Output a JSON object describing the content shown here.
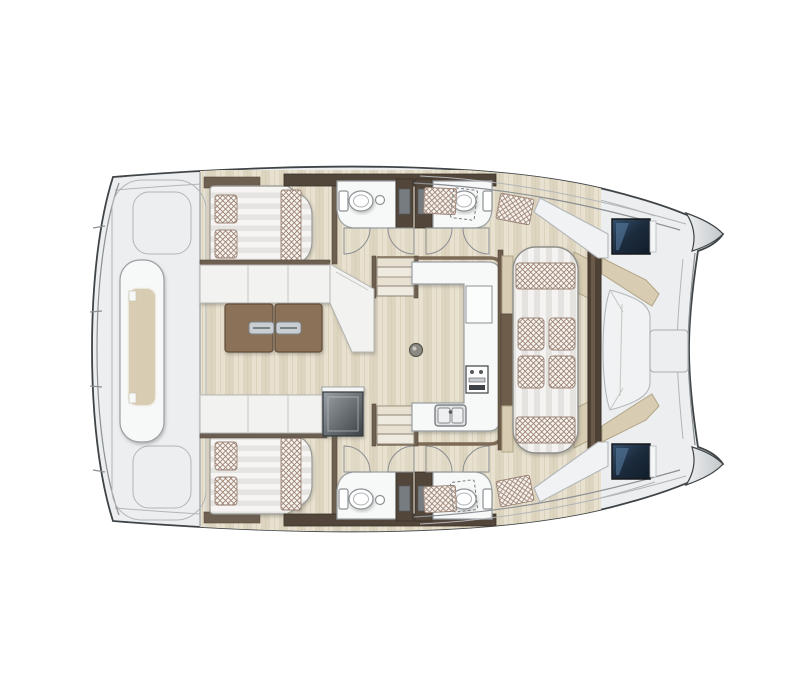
{
  "page": {
    "background": "#ffffff",
    "title": "Catamaran deck-plan illustration, top view, bow facing right"
  },
  "plan": {
    "type": "yacht-floor-plan",
    "vessel": "sailing catamaran",
    "view": "top-down",
    "orientation": "bow-right",
    "areas": [
      {
        "id": "aft-platform",
        "label": "Aft platform with central sun lounger"
      },
      {
        "id": "port-aft-cabin",
        "label": "Port double-berth cabin with pillows"
      },
      {
        "id": "starboard-aft-cabin",
        "label": "Starboard double-berth cabin with pillows"
      },
      {
        "id": "port-bathrooms",
        "label": "Two port bathrooms with toilet and washbasin"
      },
      {
        "id": "starboard-bathrooms",
        "label": "Two starboard bathrooms with toilet and washbasin"
      },
      {
        "id": "salon",
        "label": "Salon with L-shaped sofa and twin folding table"
      },
      {
        "id": "galley",
        "label": "U-shaped galley with stove and double sink"
      },
      {
        "id": "lounge-dinette",
        "label": "Athwartship lounge with scatter cushions"
      },
      {
        "id": "forward-cockpit",
        "label": "Forward cockpit bench seating with deck hatches"
      },
      {
        "id": "bows",
        "label": "Twin bow tips with side-deck tread pads"
      }
    ],
    "fixtures": [
      "toilet",
      "washbasin",
      "stove-control-panel",
      "double-sink",
      "companionway-stairs",
      "door-swing",
      "sun-lounger",
      "scatter-cushion",
      "deck-hatch-window",
      "table-handle",
      "cooler-box",
      "tread-pad"
    ],
    "counts": {
      "cabins": 2,
      "bathrooms": 4,
      "toilets": 4,
      "deck_hatches": 2,
      "door_swings": 8
    },
    "palette": {
      "background": "#ffffff",
      "deck_grey": "#eceef0",
      "outline_dark": "#3f4447",
      "wood_floor": "#e3dcc8",
      "furniture_white": "#f2f2f1",
      "accent_beige": "#d8cdb2",
      "wall_brown_dark": "#52453a",
      "table_brown": "#8a7158",
      "lattice_mauve": "#9d8374",
      "hatch_navy": "#1c2b3d",
      "metal_silver": "#c9ced2"
    }
  }
}
